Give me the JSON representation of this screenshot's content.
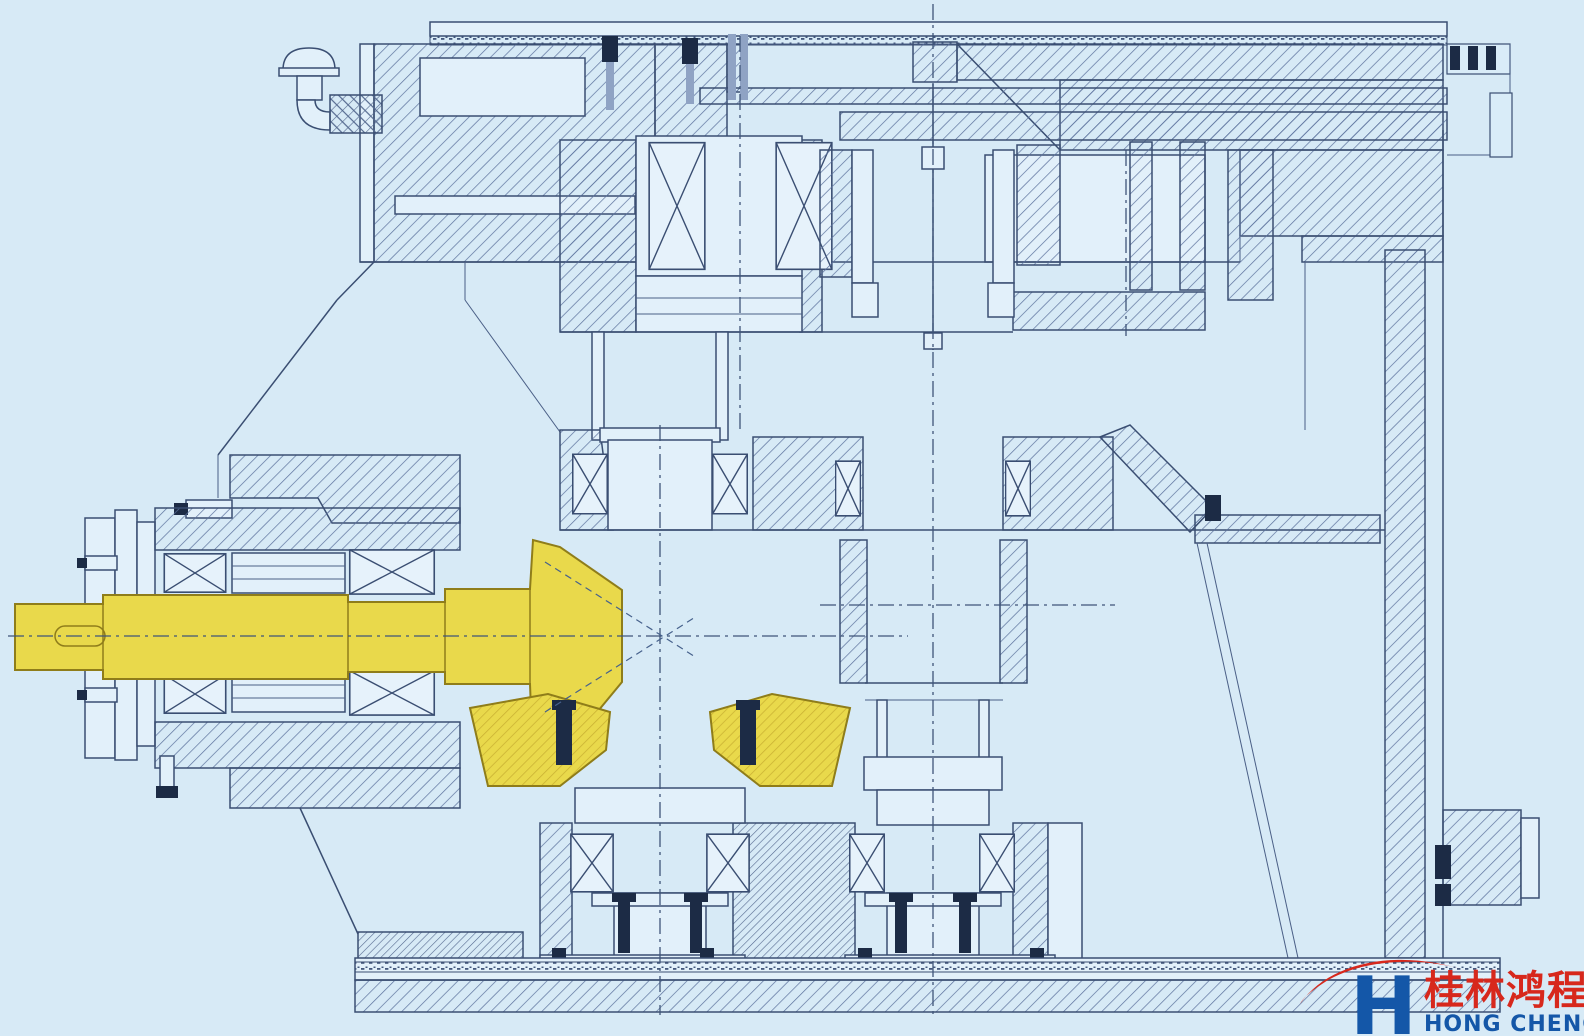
{
  "colors": {
    "background": "#d7eaf6",
    "paper_face": "#e2f0fa",
    "line": "#3a4e72",
    "hatch_line": "#5b719c",
    "highlight_yellow": "#e9d94b",
    "highlight_outline": "#8f7d1a",
    "fastener_dark": "#1c2b45",
    "logo_red": "#d7281c",
    "logo_blue": "#1457a8"
  },
  "logo": {
    "letter": "H",
    "name_cn": "桂林鸿程",
    "name_en": "HONG CHENG"
  }
}
